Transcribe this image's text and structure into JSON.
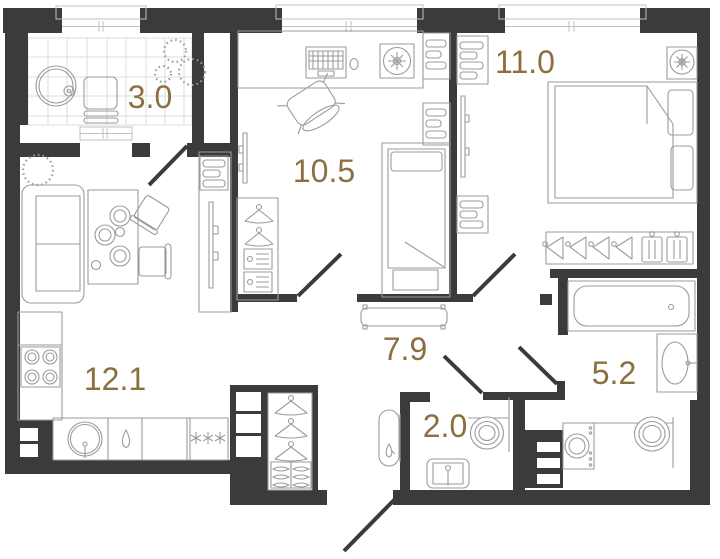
{
  "floor_plan": {
    "rooms": [
      {
        "name": "balcony",
        "area": "3.0"
      },
      {
        "name": "bedroom-small",
        "area": "10.5"
      },
      {
        "name": "bedroom-large",
        "area": "11.0"
      },
      {
        "name": "kitchen-living-room",
        "area": "12.1"
      },
      {
        "name": "hallway",
        "area": "7.9"
      },
      {
        "name": "toilet",
        "area": "2.0"
      },
      {
        "name": "bathroom",
        "area": "5.2"
      }
    ],
    "colors": {
      "wall": "#3b3b3b",
      "area_label": "#8c6f40",
      "furniture_line": "#9b9b9b",
      "tile_line": "#dcdcdc"
    },
    "fixtures": {
      "balcony": [
        "round-table",
        "cup",
        "chair",
        "plants"
      ],
      "bedroom-small": [
        "desk",
        "laptop",
        "mouse",
        "desk-fan",
        "office-chair",
        "single-bed",
        "wardrobe-with-hangers",
        "tv",
        "shelf-units"
      ],
      "bedroom-large": [
        "double-bed",
        "pillows",
        "wardrobe-hanging-clothes",
        "ceiling-fan",
        "tv",
        "shelf-units"
      ],
      "kitchen-living-room": [
        "sofa",
        "dining-table",
        "plates",
        "chairs",
        "tv-cabinet",
        "plant",
        "stove",
        "kitchen-sink",
        "fridge-freezer",
        "counter"
      ],
      "hallway": [
        "bench",
        "built-in-closet-hangers",
        "folded-clothes",
        "shelf-niche"
      ],
      "toilet": [
        "water-heater",
        "toilet",
        "hand-sink"
      ],
      "bathroom": [
        "bathtub",
        "vanity-sink",
        "washing-machine",
        "toilet",
        "duct-shaft"
      ]
    }
  }
}
